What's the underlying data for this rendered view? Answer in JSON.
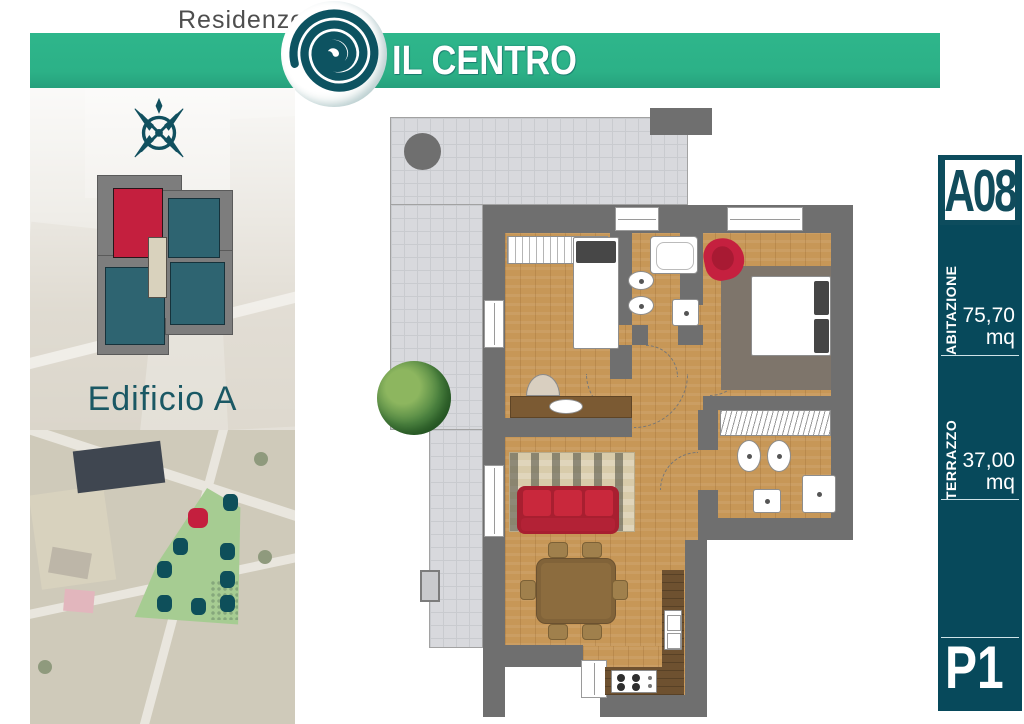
{
  "header": {
    "brand_prefix": "Residenze",
    "brand_name": "IL CENTRO"
  },
  "left_panel": {
    "building_label": "Edificio A"
  },
  "right_panel": {
    "unit_code": "A08",
    "sections": [
      {
        "label": "ABITAZIONE",
        "value": "75,70",
        "unit": "mq"
      },
      {
        "label": "TERRAZZO",
        "value": "37,00",
        "unit": "mq"
      }
    ],
    "floor_label": "P1"
  },
  "floor_plan": {
    "rooms": [
      "terrazzo",
      "camera",
      "bagno",
      "camera matrimoniale",
      "bagno 2",
      "disimpegno",
      "soggiorno",
      "cucina"
    ],
    "furniture": [
      "round-table",
      "tree",
      "wardrobe",
      "single-bed",
      "desk",
      "bathtub",
      "sink",
      "bidet",
      "washbasin",
      "armchair",
      "double-bed",
      "rug",
      "closet",
      "shower",
      "sofa",
      "striped-rug",
      "dining-table",
      "dining-chairs",
      "kitchen-counter",
      "kitchen-sink",
      "stove",
      "planter"
    ]
  },
  "icons": {
    "logo": "spiral-logo",
    "compass": "compass-rose"
  },
  "colors": {
    "banner_green": "#2cb187",
    "panel_teal": "#07495b",
    "accent_red": "#c41f3e",
    "wall_gray": "#6f6f6f",
    "wood_floor": "#c79757",
    "terrace_tile": "#d8d9dd",
    "site_building_teal": "#2e6471",
    "site_area_green": "#a6cc92"
  }
}
